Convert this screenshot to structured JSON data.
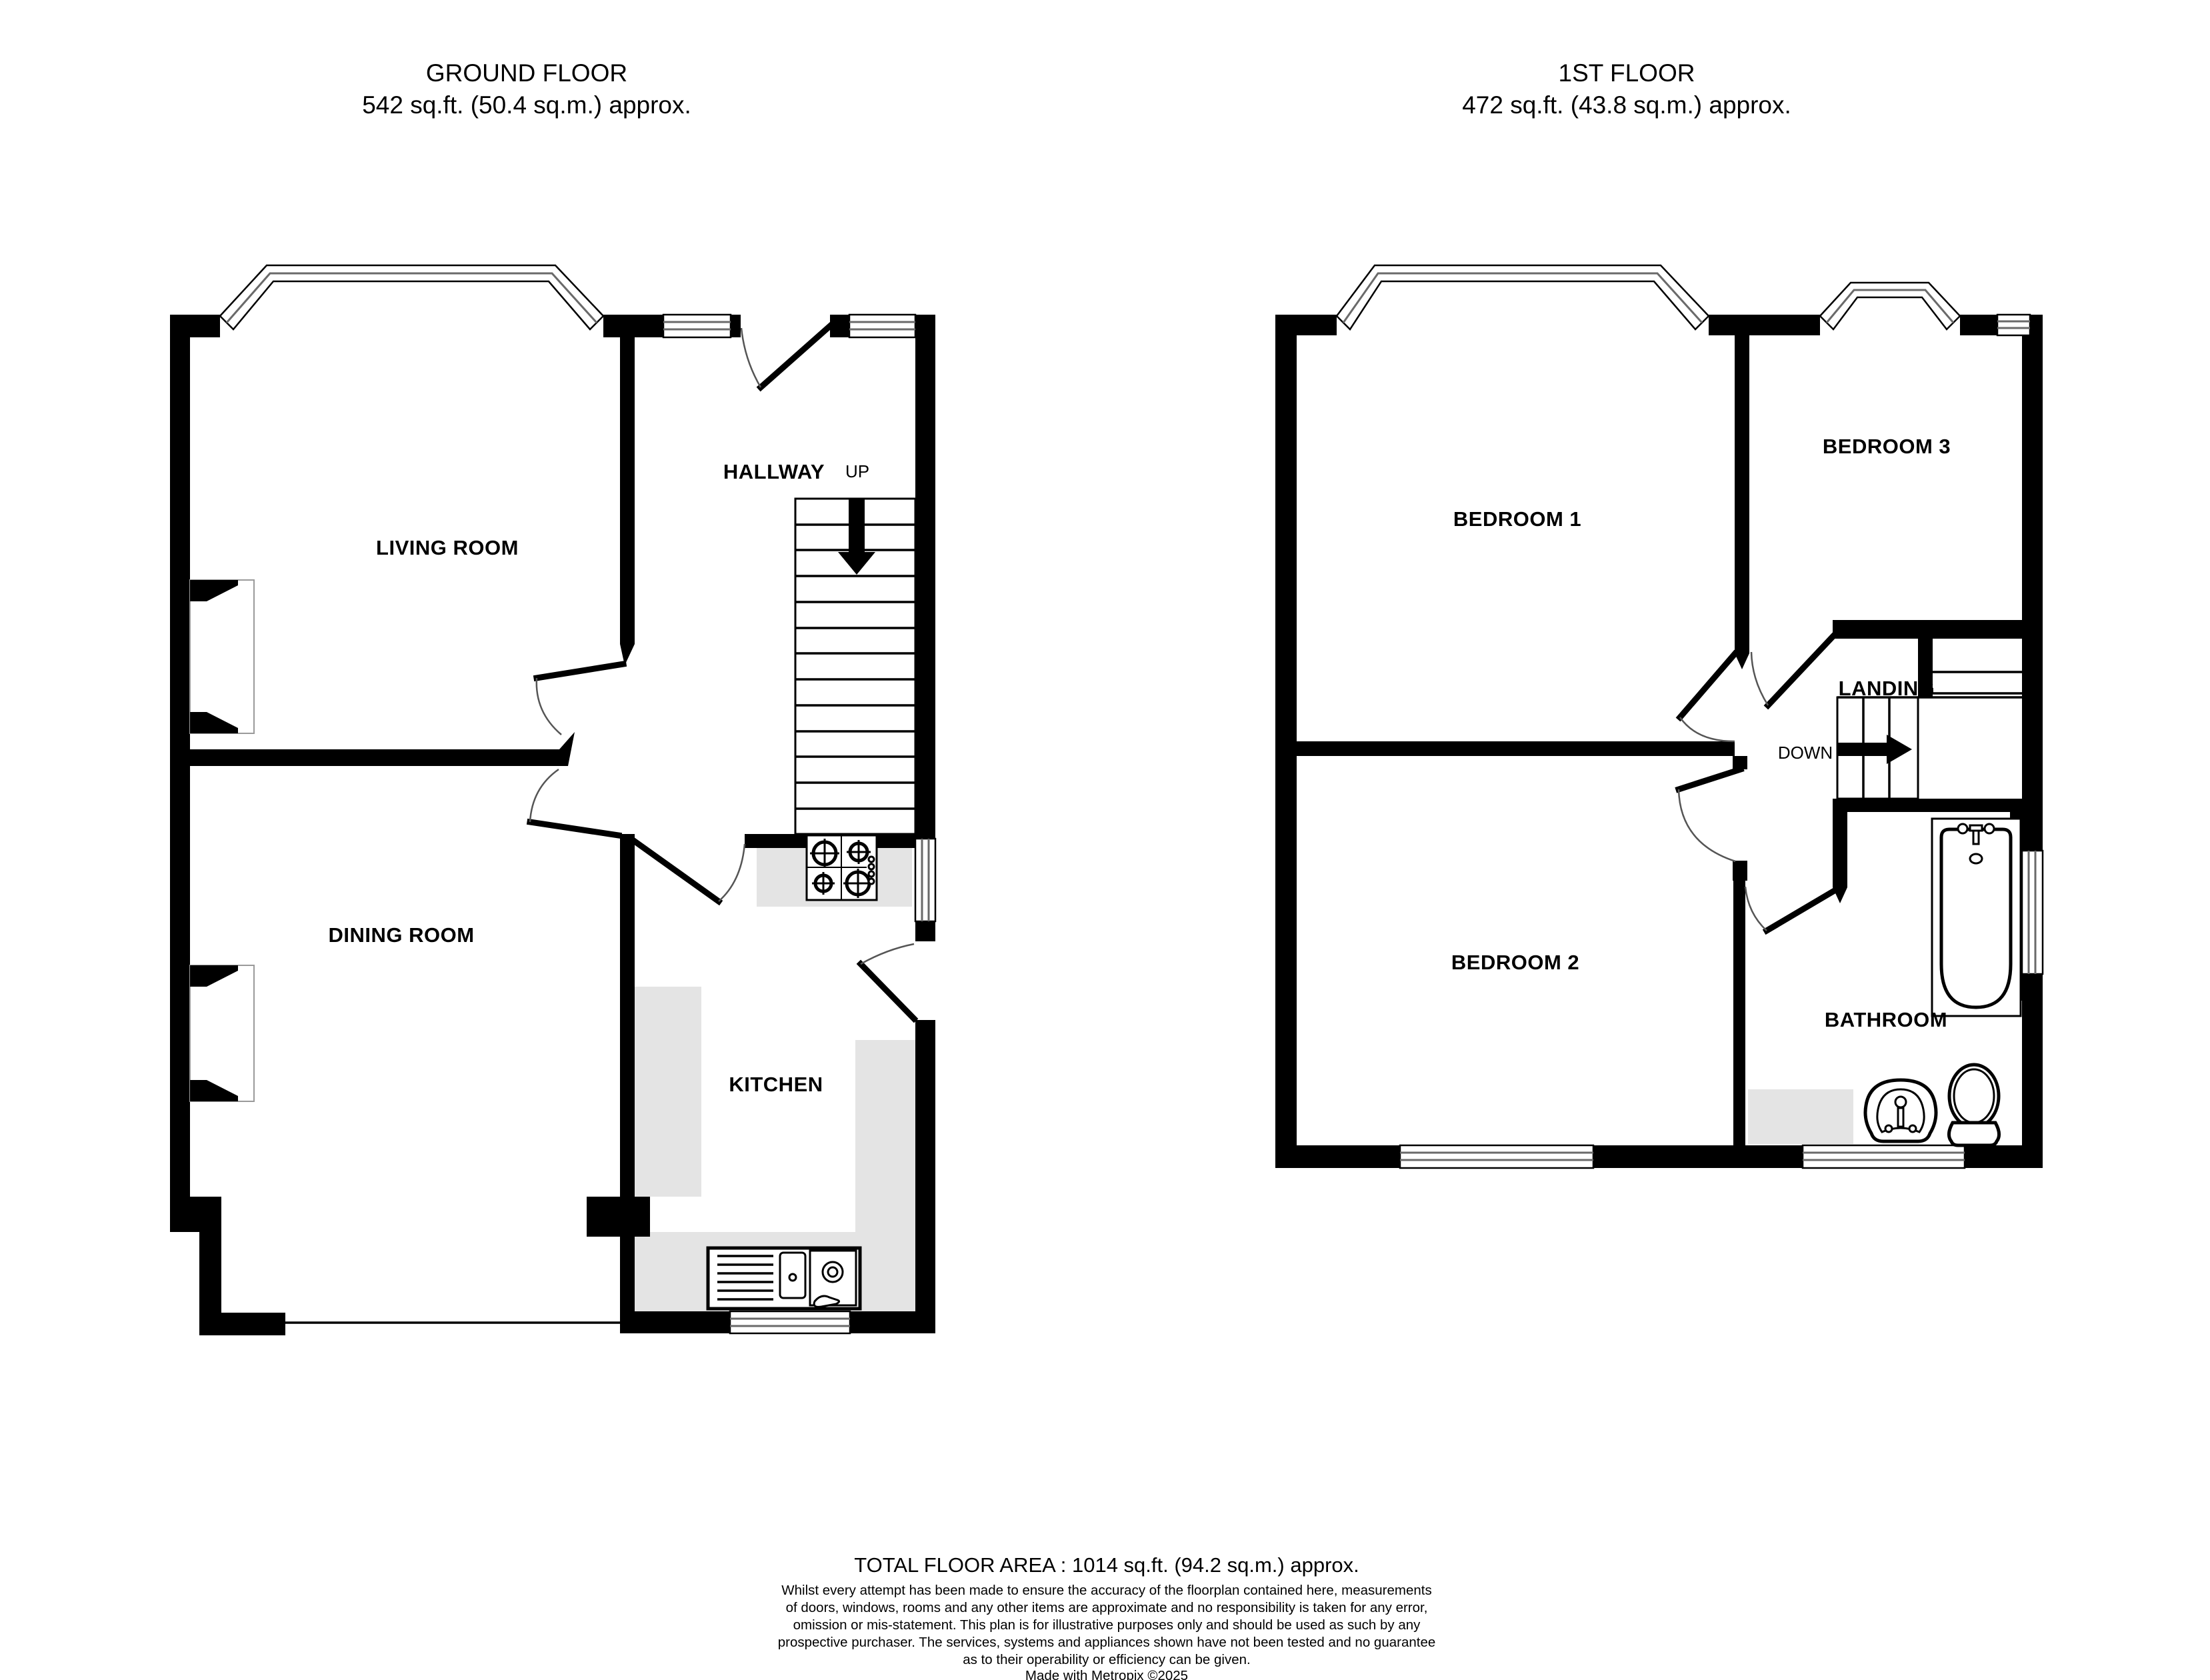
{
  "ground_floor": {
    "title_line1": "GROUND FLOOR",
    "title_line2": "542 sq.ft. (50.4 sq.m.) approx.",
    "labels": {
      "living_room": "LIVING ROOM",
      "dining_room": "DINING ROOM",
      "kitchen": "KITCHEN",
      "hallway": "HALLWAY",
      "stairs_direction": "UP"
    }
  },
  "first_floor": {
    "title_line1": "1ST FLOOR",
    "title_line2": "472 sq.ft. (43.8 sq.m.) approx.",
    "labels": {
      "bedroom1": "BEDROOM 1",
      "bedroom2": "BEDROOM 2",
      "bedroom3": "BEDROOM 3",
      "landing": "LANDING",
      "bathroom": "BATHROOM",
      "stairs_direction": "DOWN"
    }
  },
  "footer": {
    "total_area": "TOTAL FLOOR AREA : 1014 sq.ft. (94.2 sq.m.) approx.",
    "disclaimer_lines": [
      "Whilst every attempt has been made to ensure the accuracy of the floorplan contained here, measurements",
      "of doors, windows, rooms and any other items are approximate and no responsibility is taken for any error,",
      "omission or mis-statement. This plan is for illustrative purposes only and should be used as such by any",
      "prospective purchaser. The services, systems and appliances shown have not been tested and no guarantee",
      "as to their operability or efficiency can be given."
    ],
    "credit": "Made with Metropix ©2025"
  },
  "colors": {
    "wall": "#000000",
    "counter": "#e4e4e4",
    "window_line": "#6a6a6a"
  }
}
